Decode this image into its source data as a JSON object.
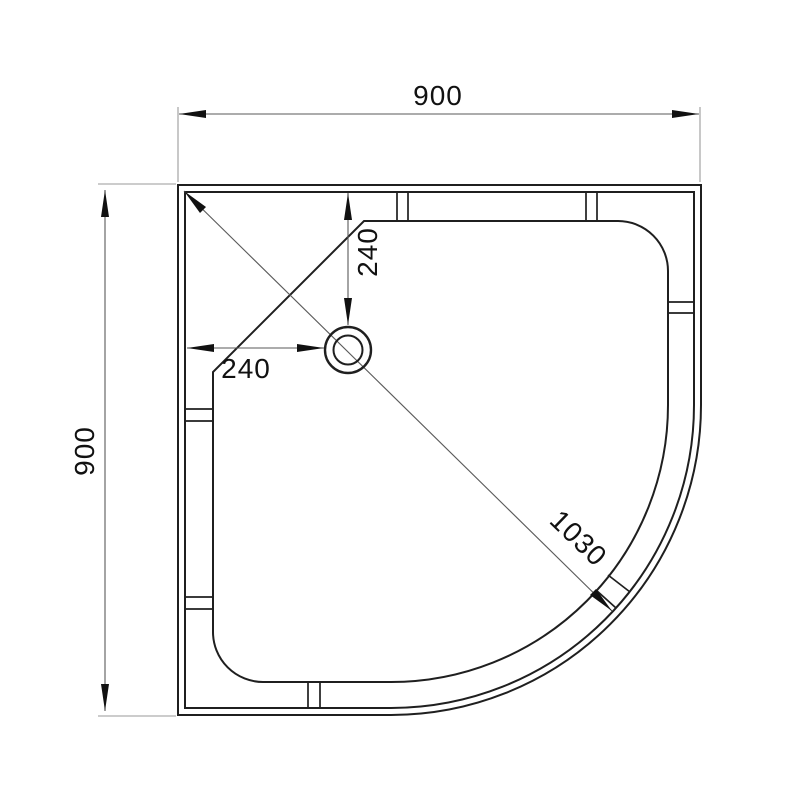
{
  "page": {
    "background": "#ffffff"
  },
  "drawing": {
    "type": "technical-dimension-drawing",
    "subject": "quadrant-shower-tray-top-view",
    "units": "mm",
    "dimensions": {
      "overall_width": "900",
      "overall_depth": "900",
      "drain_offset_horizontal": "240",
      "drain_offset_vertical": "240",
      "corner_diagonal": "1030"
    },
    "features": {
      "drain": "waste-outlet-circles",
      "rim": "double-line-border",
      "corner": "rounded-quadrant-front",
      "inner_corner": "chamfered-back-corner",
      "notches": "rim-tile-upstand-marks"
    },
    "colors": {
      "outline": "#1f1f1f",
      "dimension_line": "#5a5a5a",
      "extension_line": "#9a9a9a",
      "text": "#111111",
      "background": "#ffffff"
    }
  }
}
